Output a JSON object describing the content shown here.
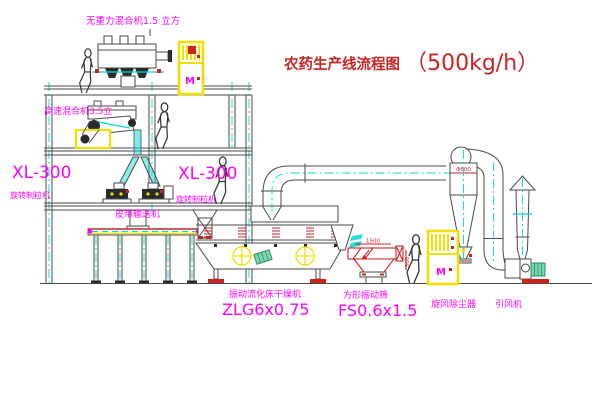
{
  "title": {
    "name": "农药生产线流程图",
    "capacity": "（500kg/h）"
  },
  "labels": {
    "top_mixer": "无重力混合机1.5 立方",
    "floor2_mixer": "高速混合机3.5立",
    "granulator_model_left": "XL-300",
    "granulator_name_left": "旋转制粒机",
    "granulator_model_mid": "XL-300",
    "granulator_name_mid": "旋转制粒机",
    "belt_conveyor": "皮带输送机",
    "dryer_name": "振动流化床干燥机",
    "dryer_model": "ZLG6x0.75",
    "sieve_name": "方形振动筛",
    "sieve_model": "FS0.6x1.5",
    "cyclone_name": "旋风除尘器",
    "fan_name": "引风机",
    "motor_symbol": "M",
    "dims": {
      "sieve_length": "1500",
      "sieve_height": "500",
      "cyclone_dia": "Φ600"
    }
  },
  "colors": {
    "magenta": "#ff00ff",
    "red": "#cc2222",
    "yellow": "#f0e000",
    "cyan": "#00d8d8",
    "line": "#4a4a4a",
    "green": "#7bd8ae"
  }
}
